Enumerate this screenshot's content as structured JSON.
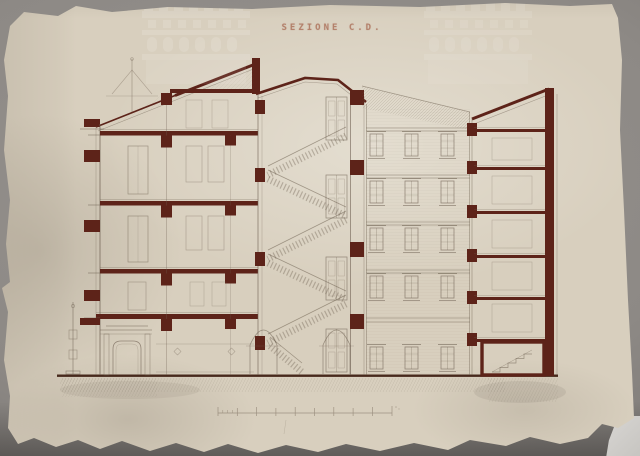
{
  "artwork": {
    "title": "SEZIONE C.D.",
    "type": "architectural cross-section drawing on aged torn paper",
    "building": {
      "front_floors": 5,
      "stair_flights": 5,
      "courtyard_window_columns": 3,
      "courtyard_window_rows": 5,
      "rear_wing_floors": 6
    }
  },
  "scale_bar": {
    "divisions": 9
  },
  "watermark": {
    "name": "castle-emblem",
    "count": 2
  },
  "colors": {
    "background": "#8d8985",
    "paper": "#d8cfbe",
    "section_cut": "#5d2319",
    "ink": "#6e6051",
    "watermark": "#ffffff"
  }
}
